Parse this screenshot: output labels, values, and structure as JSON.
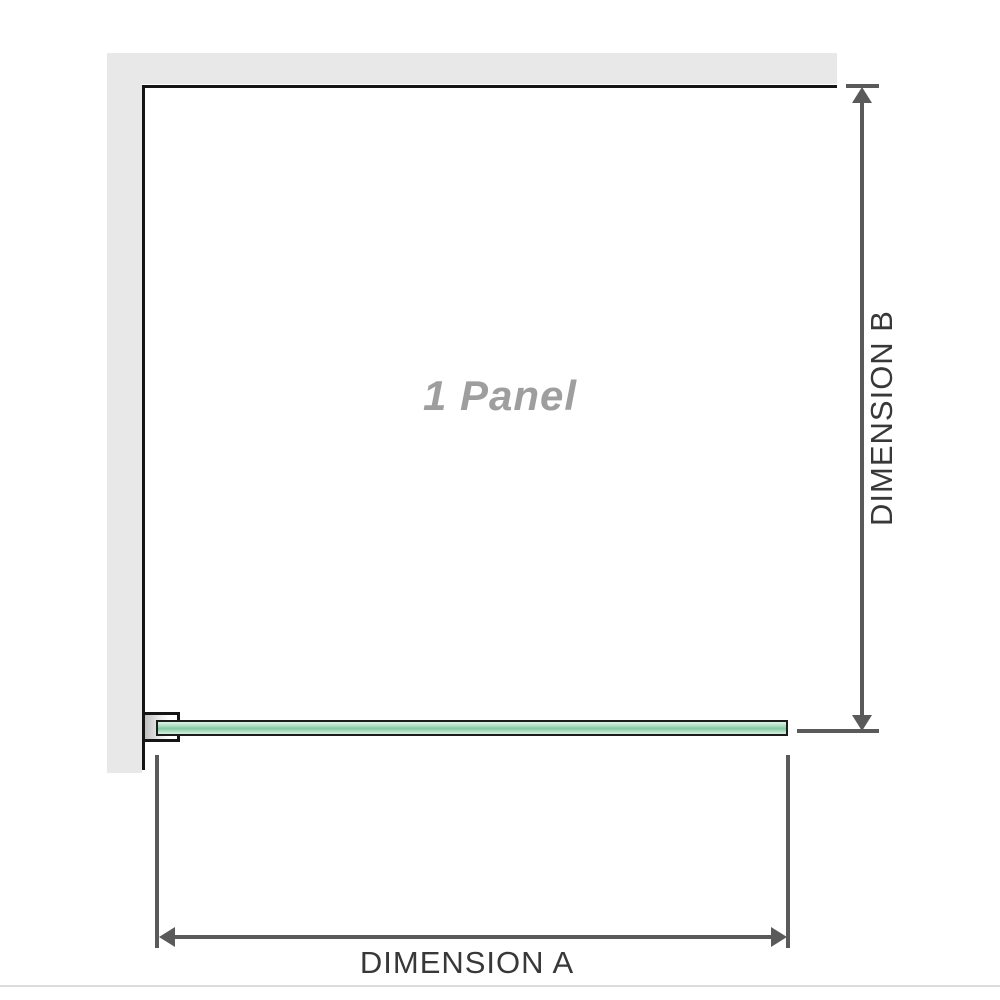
{
  "diagram": {
    "panel_label": "1 Panel",
    "dimension_a_label": "DIMENSION A",
    "dimension_b_label": "DIMENSION B"
  },
  "colors": {
    "wall": "#e8e8e8",
    "outline": "#151515",
    "glass_border": "#1c1c1c",
    "glass_light": "#dff2e8",
    "glass_mid": "#85c6a2",
    "dimension": "#5a5a5a",
    "dimension_text": "#383838",
    "panel_text": "#9e9e9e",
    "baseline": "#dcdcdc",
    "bracket_shadow": "#c0c0c0"
  }
}
